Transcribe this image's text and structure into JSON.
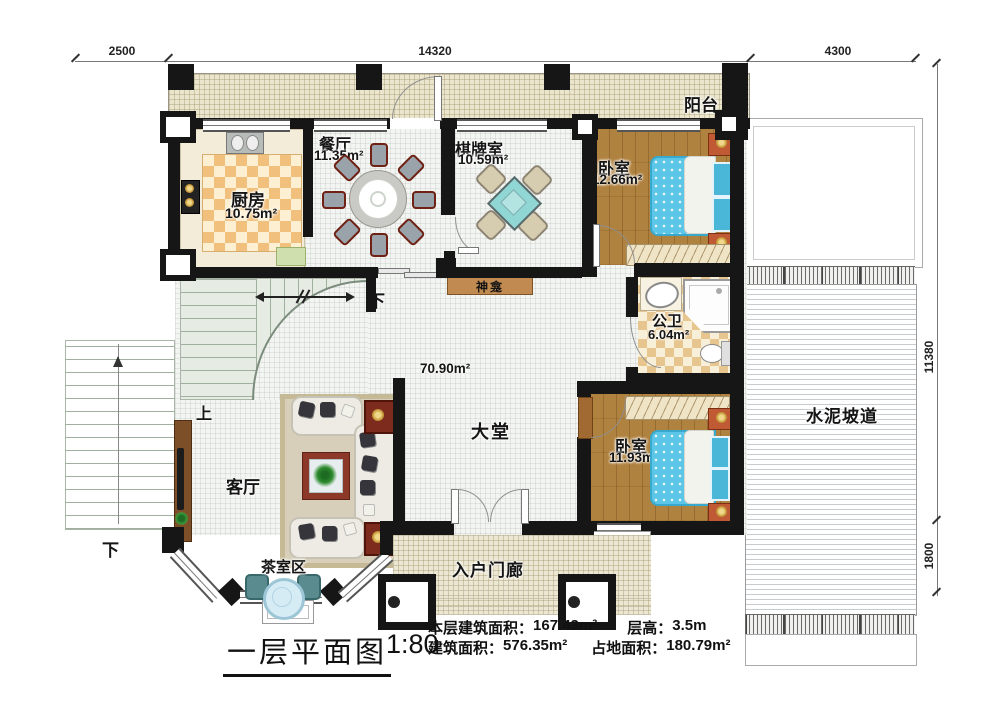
{
  "dimensions": {
    "top_left": "2500",
    "top_middle": "14320",
    "top_right": "4300",
    "right_upper": "11380",
    "right_lower": "1800"
  },
  "rooms": {
    "balcony": {
      "name": "阳台"
    },
    "kitchen": {
      "name": "厨房",
      "area": "10.75m²"
    },
    "dining": {
      "name": "餐厅",
      "area": "11.35m²"
    },
    "game_room": {
      "name": "棋牌室",
      "area": "10.59m²"
    },
    "bedroom_top": {
      "name": "卧室",
      "area": "12.66m²"
    },
    "bathroom": {
      "name": "公卫",
      "area": "6.04m²"
    },
    "shrine": {
      "name": "神龛"
    },
    "hall": {
      "name": "大堂",
      "area": "70.90m²"
    },
    "bedroom_bottom": {
      "name": "卧室",
      "area": "11.93m²"
    },
    "living_room": {
      "name": "客厅"
    },
    "tea_area": {
      "name": "茶室区"
    },
    "entry_porch": {
      "name": "入户门廊"
    },
    "cement_ramp": {
      "name": "水泥坡道"
    }
  },
  "stairs": {
    "up_label": "上",
    "down_label_inner": "下",
    "down_label_outer": "下"
  },
  "footer": {
    "title": "一层平面图",
    "scale": "1:80",
    "stats": {
      "floor_area_label": "本层建筑面积：",
      "floor_area_value": "167.43m²",
      "story_height_label": "层高：",
      "story_height_value": "3.5m",
      "gross_area_label": "建筑面积：",
      "gross_area_value": "576.35m²",
      "footprint_label": "占地面积：",
      "footprint_value": "180.79m²"
    }
  },
  "colors": {
    "wall": "#161616",
    "balcony_floor": "#eae5cc",
    "kitchen_checker": "#f1c07c",
    "wood_floor": "#b0823f",
    "bed_blue": "#5cc6e8",
    "bath_checker": "#e7c58f",
    "shrine_brown": "#c08a50",
    "stair_green": "#e6ece4",
    "rug": "#d8cfba",
    "accent_table_red": "#7c2b1d",
    "tea_chair_teal": "#5a8c8f"
  }
}
